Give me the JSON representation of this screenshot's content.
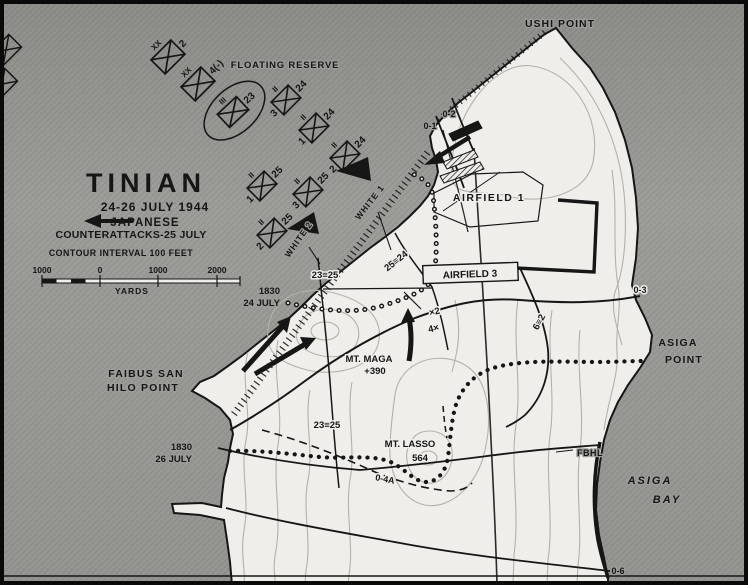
{
  "map": {
    "title_block": {
      "title": "TINIAN",
      "dates": "24-26 JULY 1944",
      "legend_line1": "JAPANESE",
      "legend_line2": "COUNTERATTACKS-25 JULY",
      "contour_note": "CONTOUR INTERVAL 100 FEET"
    },
    "scale_bar": {
      "left_1000": "1000",
      "zero": "0",
      "mid_1000": "1000",
      "right_2000": "2000",
      "unit": "YARDS"
    },
    "places": {
      "ushi_point": "USHI POINT",
      "faibus_line1": "FAIBUS SAN",
      "faibus_line2": "HILO POINT",
      "asiga_pt_line1": "ASIGA",
      "asiga_pt_line2": "POINT",
      "asiga_bay_line1": "ASIGA",
      "asiga_bay_line2": "BAY",
      "mt_maga": "MT. MAGA",
      "mt_maga_elev": "+390",
      "mt_lasso": "MT. LASSO",
      "mt_lasso_elev": "564",
      "airfield_1": "AIRFIELD   1",
      "airfield_3": "AIRFIELD   3",
      "fbhl": "FBHL",
      "floating_reserve": "FLOATING RESERVE"
    },
    "phase_lines": {
      "o1": "0-1",
      "o2": "0-2",
      "o3": "0-3",
      "o4a": "0-4A",
      "o6": "0-6"
    },
    "front_lines": {
      "fl24_time": "1830",
      "fl24_date": "24 JULY",
      "fl26_time": "1830",
      "fl26_date": "26 JULY"
    },
    "boundaries": {
      "b_23_25": "23≡25",
      "b_25_24": "25≡24",
      "b_6_2": "6≡2",
      "div_top": "×2",
      "div_bot": "4×"
    },
    "beaches": {
      "white1": "WHITE 1",
      "white2": "WHITE 2"
    },
    "units": [
      {
        "echelon": "XX",
        "number": "2",
        "sub": ""
      },
      {
        "echelon": "XX",
        "number": "4(-)",
        "sub": ""
      },
      {
        "echelon": "III",
        "number": "23",
        "sub": ""
      },
      {
        "echelon": "II",
        "number": "24",
        "sub": "3"
      },
      {
        "echelon": "II",
        "number": "24",
        "sub": "1"
      },
      {
        "echelon": "II",
        "number": "24",
        "sub": "2"
      },
      {
        "echelon": "II",
        "number": "25",
        "sub": "1"
      },
      {
        "echelon": "II",
        "number": "25",
        "sub": "3"
      },
      {
        "echelon": "II",
        "number": "25",
        "sub": "2"
      }
    ],
    "colors": {
      "sea": "#9c9c99",
      "land": "#efeeea",
      "ink": "#161616",
      "contour": "#b3b1aa"
    }
  }
}
